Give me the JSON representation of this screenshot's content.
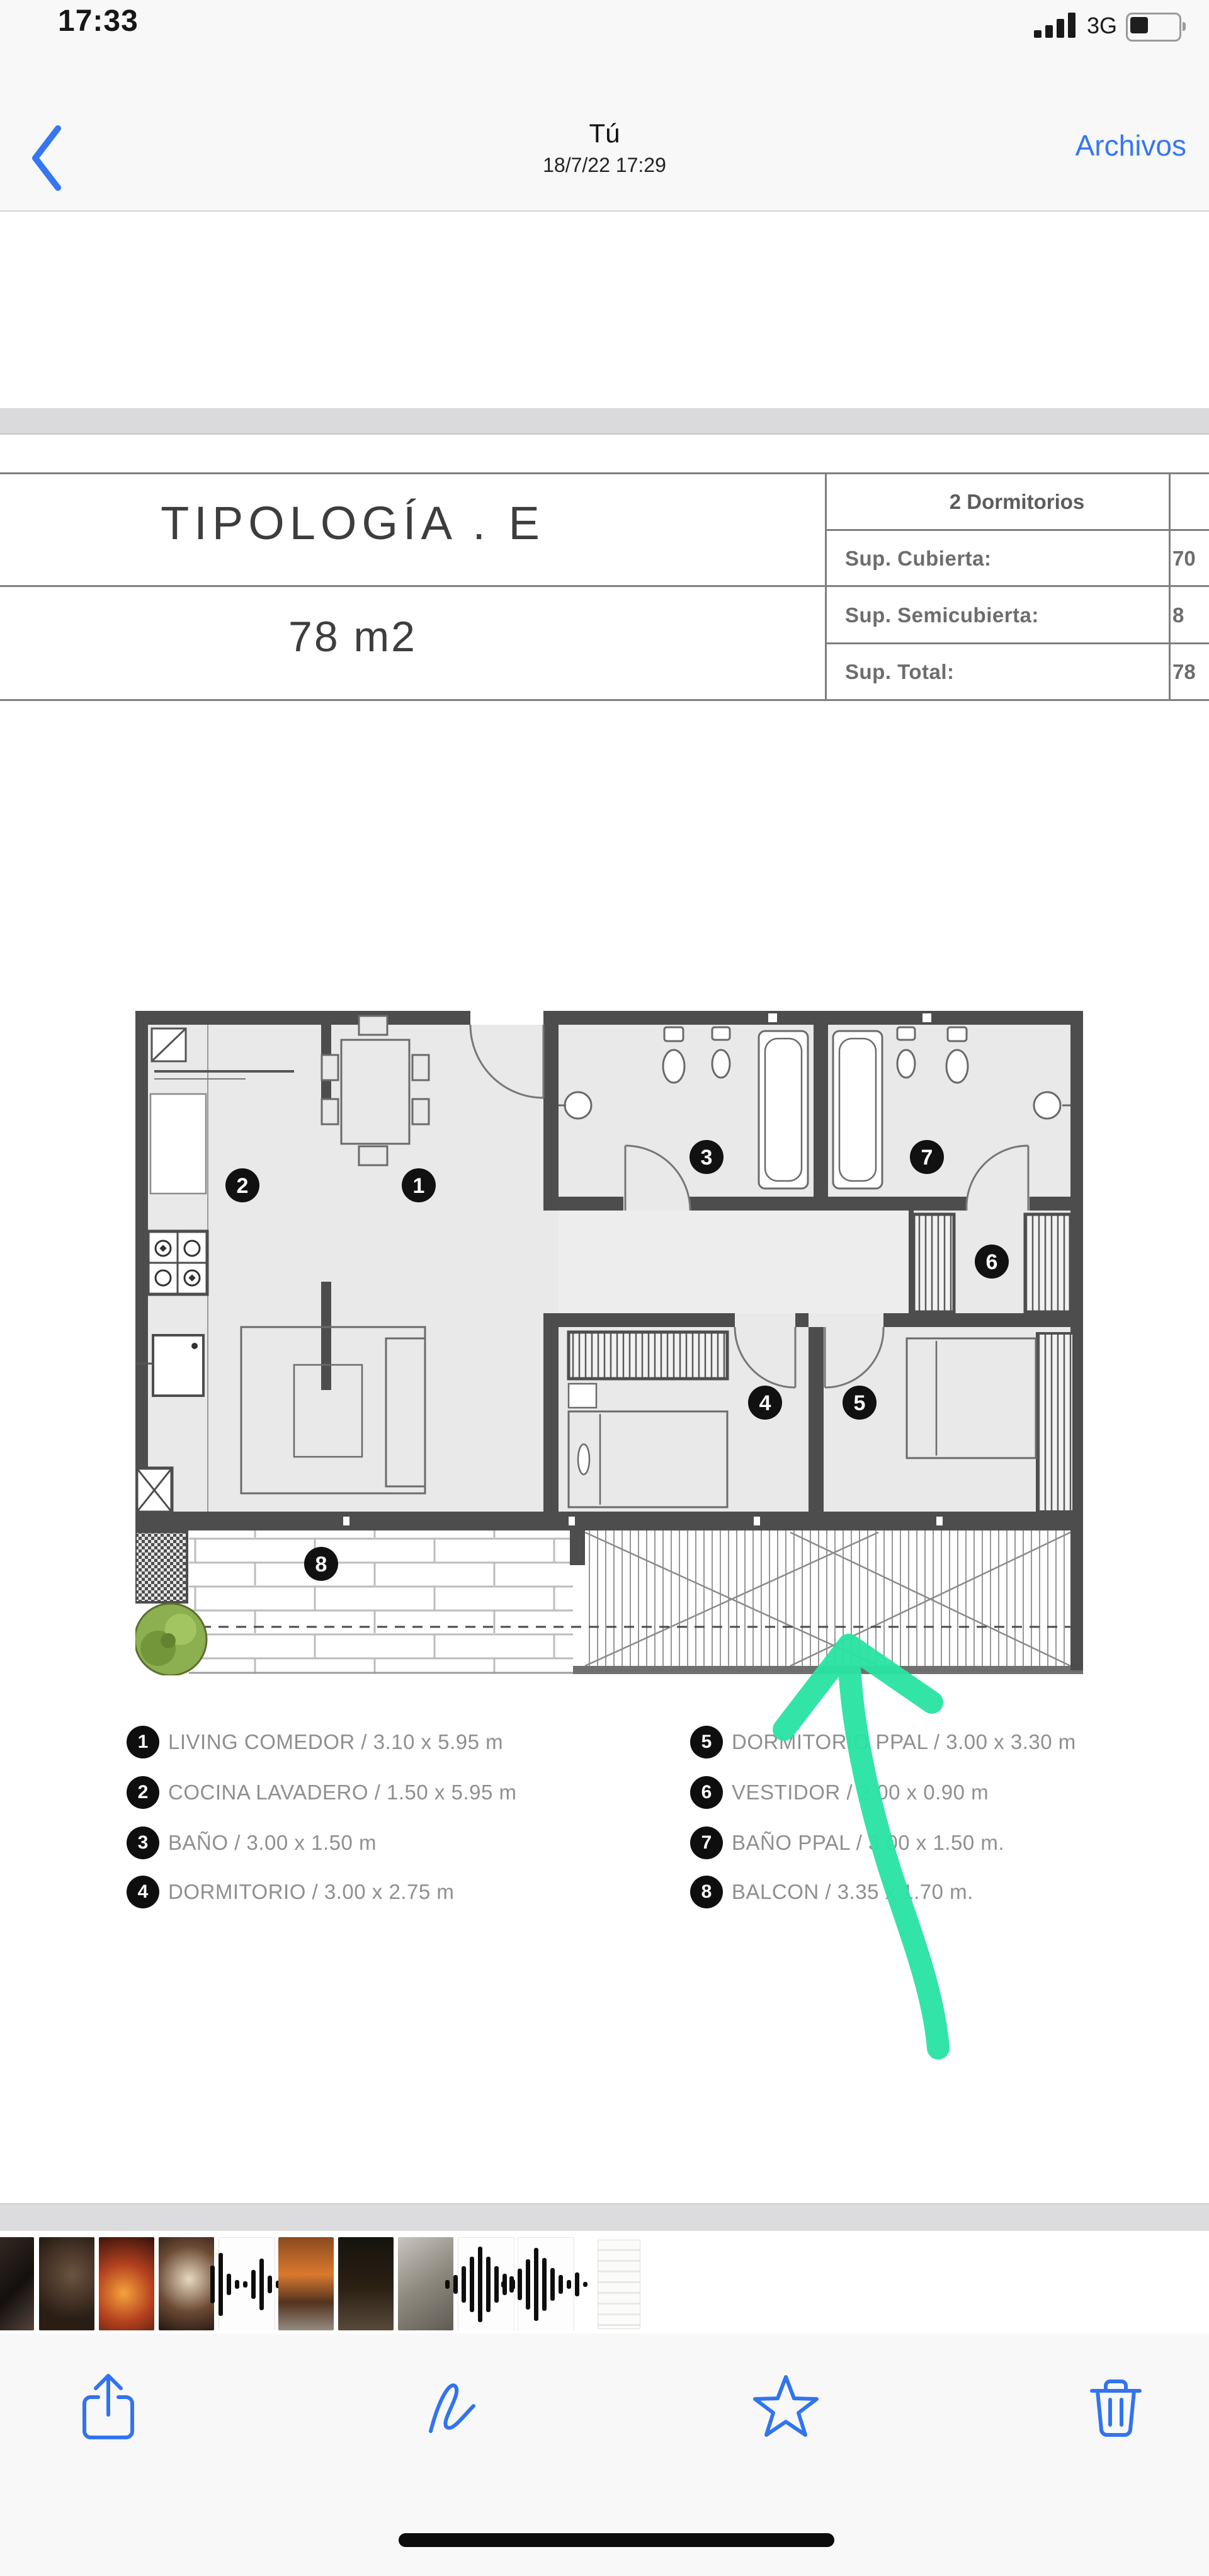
{
  "colors": {
    "accent_blue": "#3577F2",
    "arrow_green": "#2BE3A4",
    "home_indicator": "#0C0C0C"
  },
  "status_bar": {
    "time": "17:33",
    "network": "3G",
    "icons": [
      "signal-icon",
      "battery-icon"
    ]
  },
  "nav": {
    "back_icon": "chevron-left-icon",
    "title": "Tú",
    "subtitle": "18/7/22 17:29",
    "action_label": "Archivos"
  },
  "document": {
    "typology": {
      "title": "TIPOLOGÍA . E",
      "area": "78 m2"
    },
    "summary_table": {
      "header": "2 Dormitorios",
      "rows": [
        {
          "label": "Sup. Cubierta:",
          "value": "70"
        },
        {
          "label": "Sup. Semicubierta:",
          "value": "8"
        },
        {
          "label": "Sup. Total:",
          "value": "78"
        }
      ]
    },
    "plan": {
      "room_numbers": [
        "1",
        "2",
        "3",
        "4",
        "5",
        "6",
        "7",
        "8"
      ]
    },
    "legend": {
      "left": [
        {
          "number": "1",
          "text": "LIVING COMEDOR / 3.10 x 5.95 m"
        },
        {
          "number": "2",
          "text": "COCINA LAVADERO / 1.50 x 5.95 m"
        },
        {
          "number": "3",
          "text": "BAÑO / 3.00 x 1.50 m"
        },
        {
          "number": "4",
          "text": "DORMITORIO / 3.00 x 2.75 m"
        }
      ],
      "right": [
        {
          "number": "5",
          "text": "DORMITORIO PPAL / 3.00 x 3.30 m"
        },
        {
          "number": "6",
          "text": "VESTIDOR / 2.00 x 0.90 m"
        },
        {
          "number": "7",
          "text": "BAÑO PPAL / 3.00 x 1.50 m."
        },
        {
          "number": "8",
          "text": "BALCON / 3.35 x 1.70 m."
        }
      ]
    },
    "annotation": {
      "type": "hand-drawn-arrow",
      "direction": "up",
      "color": "#2BE3A4"
    }
  },
  "thumbnails": [
    "photo-dark-a",
    "photo-dark-b",
    "photo-fire",
    "photo-warm",
    "waveform",
    "photo-sunset",
    "photo-night",
    "photo-gray",
    "waveform",
    "waveform",
    "document-tile"
  ],
  "toolbar": {
    "icons": [
      "share-icon",
      "markup-icon",
      "star-icon",
      "trash-icon"
    ]
  }
}
